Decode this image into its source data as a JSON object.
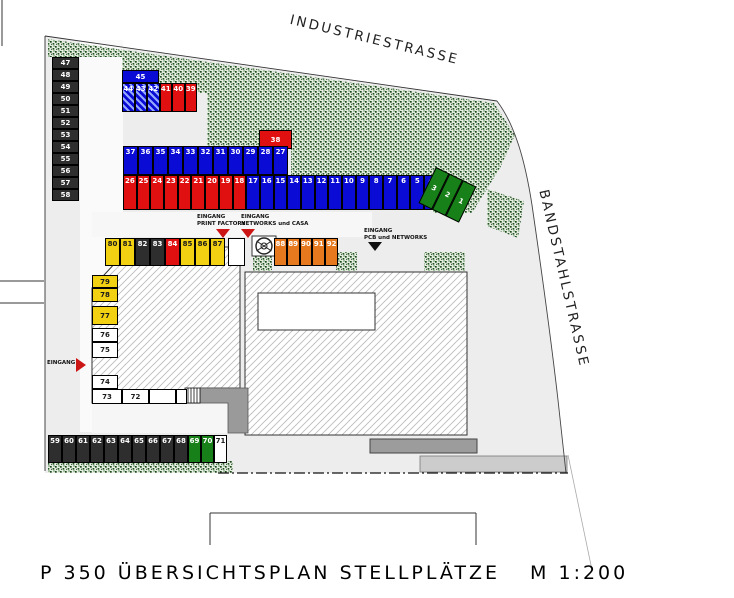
{
  "title": {
    "main": "P 350 ÜBERSICHTSPLAN STELLPLÄTZE",
    "scale": "M  1:200"
  },
  "streets": {
    "top": "INDUSTRIESTRASSE",
    "right": "BANDSTAHLSTRASSE"
  },
  "palette": {
    "blue": {
      "bg": "#0b0bd6",
      "fg": "#ffffff"
    },
    "bluehatch": {
      "bg": "#0b0bd6",
      "fg": "#ffffff"
    },
    "red": {
      "bg": "#e01010",
      "fg": "#ffffff"
    },
    "green": {
      "bg": "#188018",
      "fg": "#ffffff"
    },
    "dark": {
      "bg": "#2e2e2e",
      "fg": "#ffffff"
    },
    "yellow": {
      "bg": "#f2d112",
      "fg": "#1a1a1a"
    },
    "orange": {
      "bg": "#e6791e",
      "fg": "#ffffff"
    },
    "white": {
      "bg": "#ffffff",
      "fg": "#1a1a1a"
    }
  },
  "entrances": [
    {
      "name": "entrance-print-factory",
      "lines": [
        "EINGANG",
        "PRINT FACTORY"
      ],
      "arrow": "down",
      "color": "#cc1515",
      "x": 197,
      "y": 214,
      "ax": 216,
      "ay": 229
    },
    {
      "name": "entrance-networks-casa",
      "lines": [
        "EINGANG",
        "NETWORKS und CASA"
      ],
      "arrow": "down",
      "color": "#cc1515",
      "x": 241,
      "y": 214,
      "ax": 241,
      "ay": 229
    },
    {
      "name": "entrance-pcb-networks",
      "lines": [
        "EINGANG",
        "PCB und NETWORKS"
      ],
      "arrow": "down",
      "color": "#111111",
      "x": 364,
      "y": 228,
      "ax": 368,
      "ay": 242
    },
    {
      "name": "entrance-west",
      "lines": [
        "EINGANG"
      ],
      "arrow": "right",
      "color": "#cc1515",
      "x": 47,
      "y": 360,
      "ax": 76,
      "ay": 358
    }
  ],
  "stall_groups": [
    {
      "name": "stalls-left-column",
      "x": 52,
      "y": 57,
      "dir": "v",
      "w": 27,
      "h": 12,
      "num": "center",
      "stalls": [
        {
          "n": "47",
          "c": "dark"
        },
        {
          "n": "48",
          "c": "dark"
        },
        {
          "n": "49",
          "c": "dark"
        },
        {
          "n": "50",
          "c": "dark"
        },
        {
          "n": "51",
          "c": "dark"
        },
        {
          "n": "52",
          "c": "dark"
        },
        {
          "n": "53",
          "c": "dark"
        },
        {
          "n": "54",
          "c": "dark"
        },
        {
          "n": "55",
          "c": "dark"
        },
        {
          "n": "56",
          "c": "dark"
        },
        {
          "n": "57",
          "c": "dark"
        },
        {
          "n": "58",
          "c": "dark"
        }
      ]
    },
    {
      "name": "stall-45",
      "x": 122,
      "y": 70,
      "dir": "h",
      "w": 37,
      "h": 13,
      "num": "center",
      "stalls": [
        {
          "n": "45",
          "c": "blue"
        }
      ]
    },
    {
      "name": "stalls-44-39",
      "x": 122,
      "y": 83,
      "dir": "h",
      "w": 12.5,
      "h": 29,
      "num": "top",
      "stalls": [
        {
          "n": "44",
          "c": "bluehatch"
        },
        {
          "n": "43",
          "c": "bluehatch"
        },
        {
          "n": "42",
          "c": "bluehatch"
        },
        {
          "n": "41",
          "c": "red"
        },
        {
          "n": "40",
          "c": "red"
        },
        {
          "n": "39",
          "c": "red"
        }
      ]
    },
    {
      "name": "stall-38",
      "x": 259,
      "y": 130,
      "dir": "h",
      "w": 33,
      "h": 19,
      "num": "center",
      "stalls": [
        {
          "n": "38",
          "c": "red"
        }
      ]
    },
    {
      "name": "stalls-row-upper",
      "x": 123,
      "y": 146,
      "dir": "h",
      "w": 15,
      "h": 29,
      "num": "top",
      "stalls": [
        {
          "n": "37",
          "c": "blue"
        },
        {
          "n": "36",
          "c": "blue"
        },
        {
          "n": "35",
          "c": "blue"
        },
        {
          "n": "34",
          "c": "blue"
        },
        {
          "n": "33",
          "c": "blue"
        },
        {
          "n": "32",
          "c": "blue"
        },
        {
          "n": "31",
          "c": "blue"
        },
        {
          "n": "30",
          "c": "blue"
        },
        {
          "n": "29",
          "c": "blue"
        },
        {
          "n": "28",
          "c": "blue"
        },
        {
          "n": "27",
          "c": "blue"
        }
      ]
    },
    {
      "name": "stalls-row-lower",
      "x": 123,
      "y": 175,
      "dir": "h",
      "w": 13.7,
      "h": 35,
      "num": "top",
      "stalls": [
        {
          "n": "26",
          "c": "red"
        },
        {
          "n": "25",
          "c": "red"
        },
        {
          "n": "24",
          "c": "red"
        },
        {
          "n": "23",
          "c": "red"
        },
        {
          "n": "22",
          "c": "red"
        },
        {
          "n": "21",
          "c": "red"
        },
        {
          "n": "20",
          "c": "red"
        },
        {
          "n": "19",
          "c": "red"
        },
        {
          "n": "18",
          "c": "red"
        },
        {
          "n": "17",
          "c": "blue"
        },
        {
          "n": "16",
          "c": "blue"
        },
        {
          "n": "15",
          "c": "blue"
        },
        {
          "n": "14",
          "c": "blue"
        },
        {
          "n": "13",
          "c": "blue"
        },
        {
          "n": "12",
          "c": "blue"
        },
        {
          "n": "11",
          "c": "blue"
        },
        {
          "n": "10",
          "c": "blue"
        },
        {
          "n": "9",
          "c": "blue"
        },
        {
          "n": "8",
          "c": "blue"
        },
        {
          "n": "7",
          "c": "blue"
        },
        {
          "n": "6",
          "c": "blue"
        },
        {
          "n": "5",
          "c": "blue"
        },
        {
          "n": "4",
          "c": "blue"
        }
      ]
    },
    {
      "name": "stalls-green-1-3",
      "x": 436,
      "y": 167,
      "dir": "h",
      "w": 15,
      "h": 40,
      "num": "center",
      "rotate": 26,
      "stalls": [
        {
          "n": "3",
          "c": "green"
        },
        {
          "n": "2",
          "c": "green"
        },
        {
          "n": "1",
          "c": "green"
        }
      ]
    },
    {
      "name": "stalls-80-87",
      "x": 105,
      "y": 238,
      "dir": "h",
      "w": 15,
      "h": 28,
      "num": "top",
      "stalls": [
        {
          "n": "80",
          "c": "yellow"
        },
        {
          "n": "81",
          "c": "yellow"
        },
        {
          "n": "82",
          "c": "dark"
        },
        {
          "n": "83",
          "c": "dark"
        },
        {
          "n": "84",
          "c": "red"
        },
        {
          "n": "85",
          "c": "yellow"
        },
        {
          "n": "86",
          "c": "yellow"
        },
        {
          "n": "87",
          "c": "yellow"
        },
        {
          "n": "",
          "c": "white",
          "w": 17,
          "gap": 3
        }
      ]
    },
    {
      "name": "stalls-88-92",
      "x": 274,
      "y": 238,
      "dir": "h",
      "w": 12.8,
      "h": 28,
      "num": "top",
      "stalls": [
        {
          "n": "88",
          "c": "orange"
        },
        {
          "n": "89",
          "c": "orange"
        },
        {
          "n": "90",
          "c": "orange"
        },
        {
          "n": "91",
          "c": "orange"
        },
        {
          "n": "92",
          "c": "orange"
        }
      ]
    },
    {
      "name": "stalls-79-74",
      "x": 92,
      "y": 275,
      "dir": "v",
      "w": 26,
      "h": 14,
      "num": "center",
      "stalls": [
        {
          "n": "79",
          "c": "yellow",
          "h": 13
        },
        {
          "n": "78",
          "c": "yellow",
          "h": 14
        },
        {
          "n": "77",
          "c": "yellow",
          "h": 19,
          "gap": 4
        },
        {
          "n": "76",
          "c": "white",
          "h": 14,
          "gap": 3
        },
        {
          "n": "75",
          "c": "white",
          "h": 16
        },
        {
          "n": "74",
          "c": "white",
          "h": 14,
          "gap": 17
        }
      ]
    },
    {
      "name": "stalls-73-72",
      "x": 92,
      "y": 389,
      "dir": "h",
      "w": 30,
      "h": 15,
      "num": "center",
      "stalls": [
        {
          "n": "73",
          "c": "white",
          "w": 30
        },
        {
          "n": "72",
          "c": "white",
          "w": 27
        },
        {
          "n": "",
          "c": "white",
          "w": 27
        },
        {
          "n": "",
          "c": "white",
          "w": 11
        }
      ]
    },
    {
      "name": "stalls-59-71",
      "x": 48,
      "y": 435,
      "dir": "h",
      "w": 14,
      "h": 28,
      "num": "top",
      "stalls": [
        {
          "n": "59",
          "c": "dark"
        },
        {
          "n": "60",
          "c": "dark"
        },
        {
          "n": "61",
          "c": "dark"
        },
        {
          "n": "62",
          "c": "dark"
        },
        {
          "n": "63",
          "c": "dark"
        },
        {
          "n": "64",
          "c": "dark"
        },
        {
          "n": "65",
          "c": "dark"
        },
        {
          "n": "66",
          "c": "dark"
        },
        {
          "n": "67",
          "c": "dark"
        },
        {
          "n": "68",
          "c": "dark"
        },
        {
          "n": "69",
          "c": "green",
          "w": 13
        },
        {
          "n": "70",
          "c": "green",
          "w": 13
        },
        {
          "n": "71",
          "c": "white",
          "w": 13
        }
      ]
    }
  ]
}
